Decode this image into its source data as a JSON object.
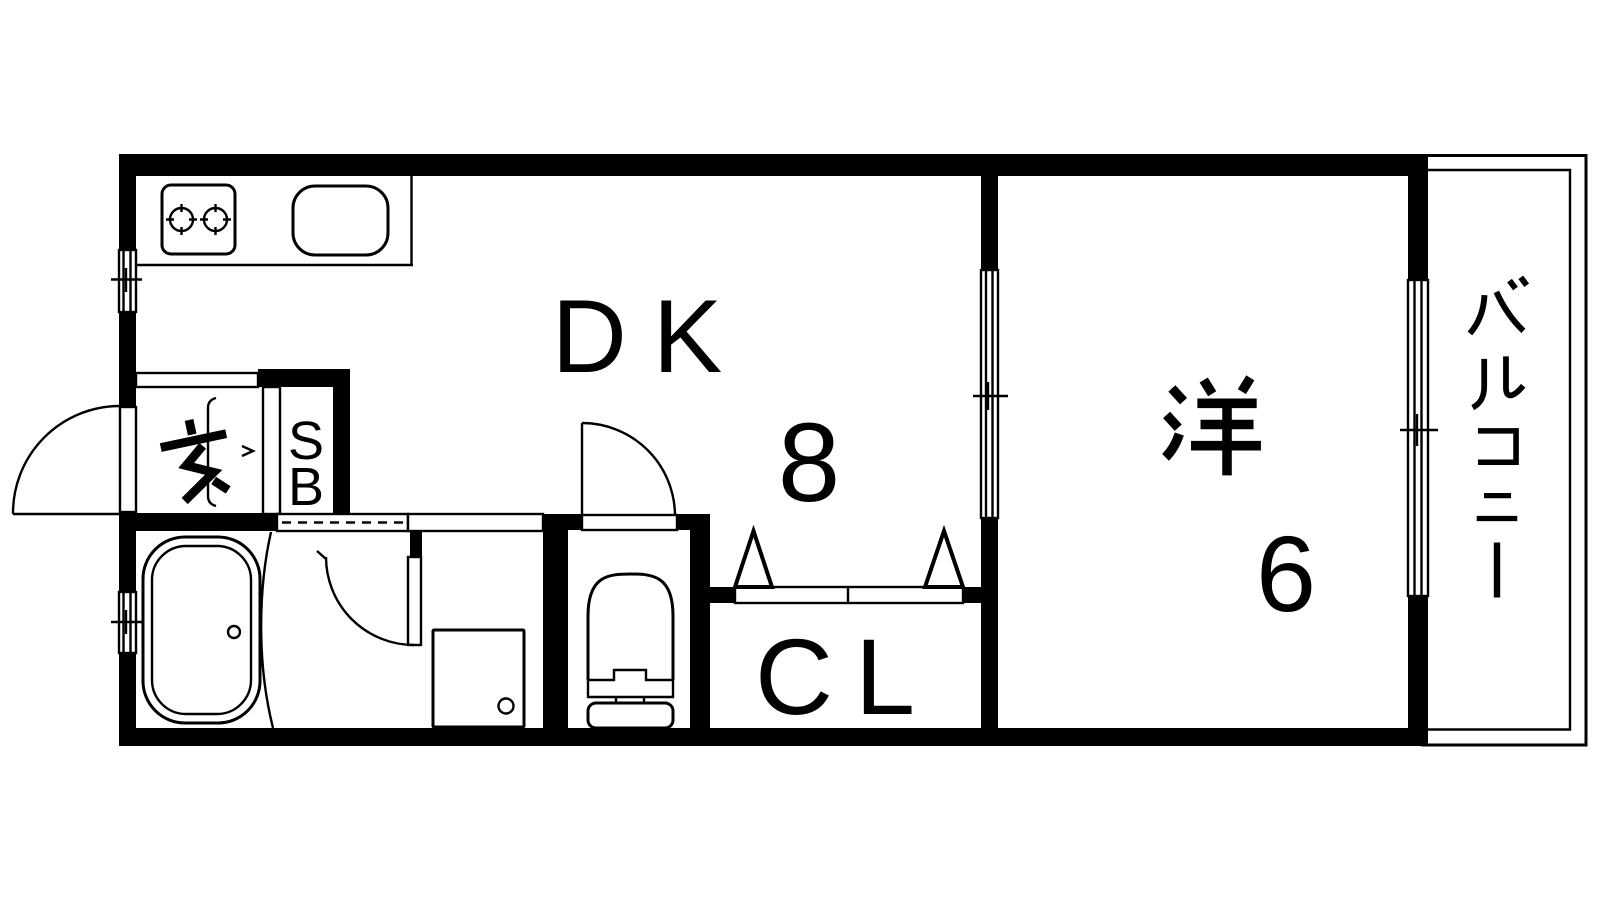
{
  "plan": {
    "rooms": {
      "dk": {
        "label": "DK",
        "size": "8"
      },
      "western_room": {
        "label": "洋",
        "size": "6"
      },
      "closet": {
        "label": "CL"
      },
      "shoe_box": {
        "label": "SB",
        "letters": [
          "S",
          "B"
        ]
      },
      "entrance": {
        "label": "玄"
      },
      "balcony": {
        "label": "バルコニー"
      }
    },
    "colors": {
      "line": "#000000",
      "background": "#ffffff"
    }
  }
}
